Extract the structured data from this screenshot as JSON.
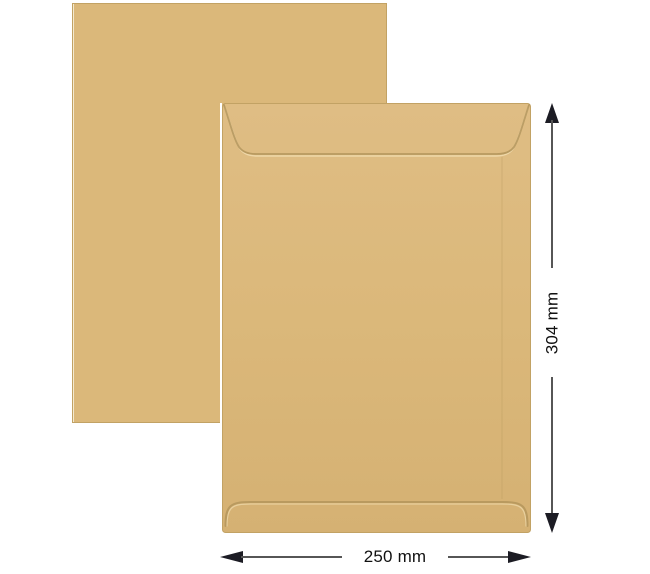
{
  "figure": {
    "height_dimension": {
      "label": "304 mm"
    },
    "width_dimension": {
      "label": "250 mm"
    },
    "colors": {
      "background": "#ffffff",
      "kraft": "#dbb87a",
      "kraft_light": "#dfbd84",
      "kraft_dark": "#d5b173",
      "kraft_edge": "#c2a264",
      "seam": "#b1945a",
      "edge_highlight": "#f4ead0",
      "dimension_line": "#565656",
      "arrowhead": "#1c1c24",
      "label_text": "#111111"
    }
  }
}
